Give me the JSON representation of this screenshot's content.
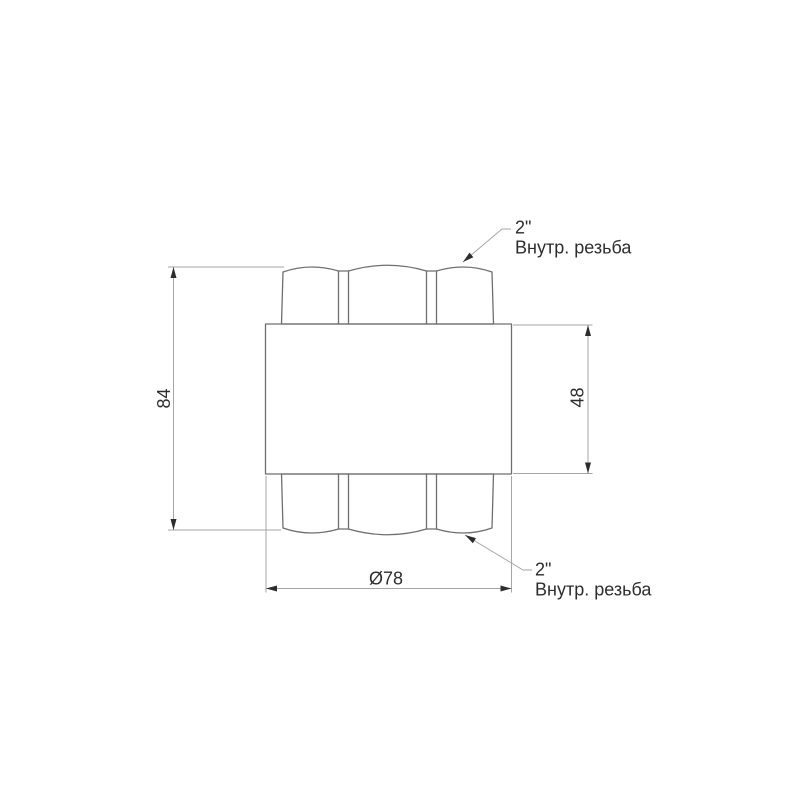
{
  "drawing": {
    "view": "front-view-pipe-fitting",
    "dimensions": {
      "total_height": "84",
      "body_height": "48",
      "diameter": "Ø78"
    },
    "callouts": {
      "top": {
        "size": "2\"",
        "thread_type": "Внутр. резьба"
      },
      "bottom": {
        "size": "2\"",
        "thread_type": "Внутр. резьба"
      }
    },
    "colors": {
      "background": "#ffffff",
      "outline": "#6f6f6f",
      "dimension_line": "#a6a6a6",
      "arrow": "#2d2d2d",
      "text": "#2d2d2d"
    }
  }
}
